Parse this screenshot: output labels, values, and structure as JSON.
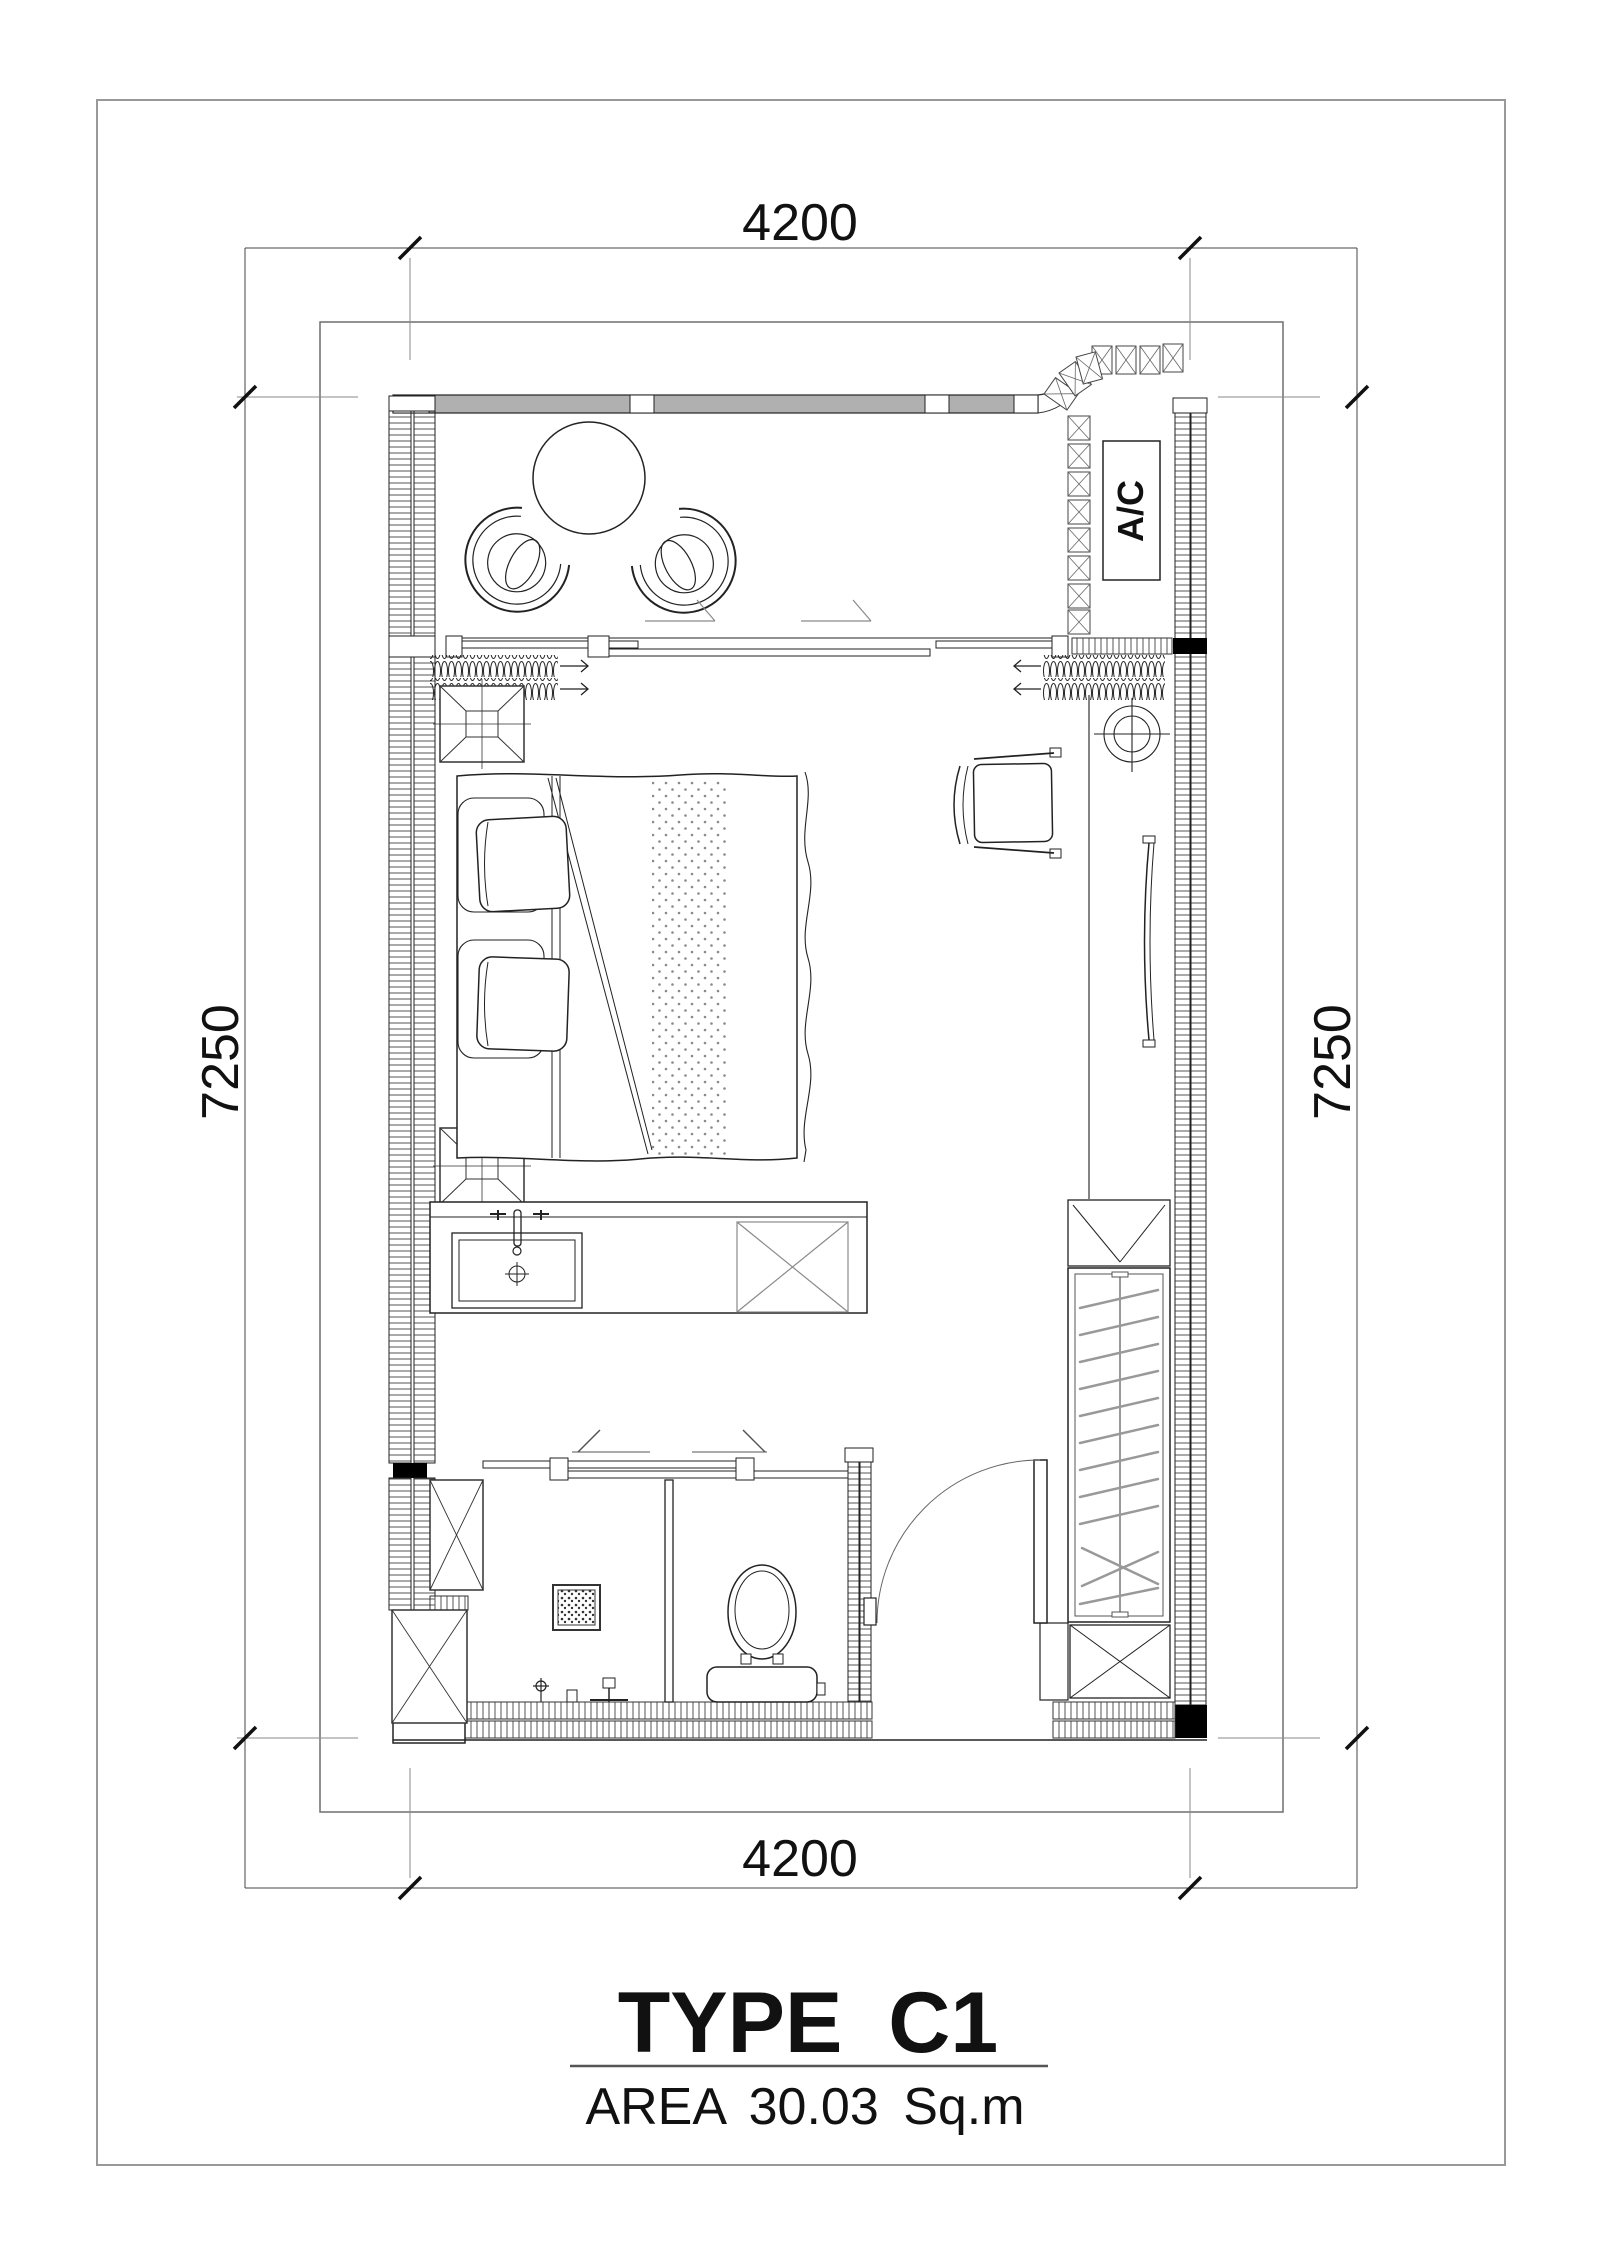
{
  "page": {
    "title_text": "TYPE C1",
    "area_text": "AREA 30.03 Sq.m"
  },
  "dimensions": {
    "top": "4200",
    "bottom": "4200",
    "left": "7250",
    "right": "7250"
  },
  "equipment": {
    "ac_label": "A/C"
  },
  "colors": {
    "line": "#1a1a1a",
    "construction_gray": "#8a8a8a",
    "wall_fill": "#b0b0b0",
    "paper": "#ffffff"
  }
}
